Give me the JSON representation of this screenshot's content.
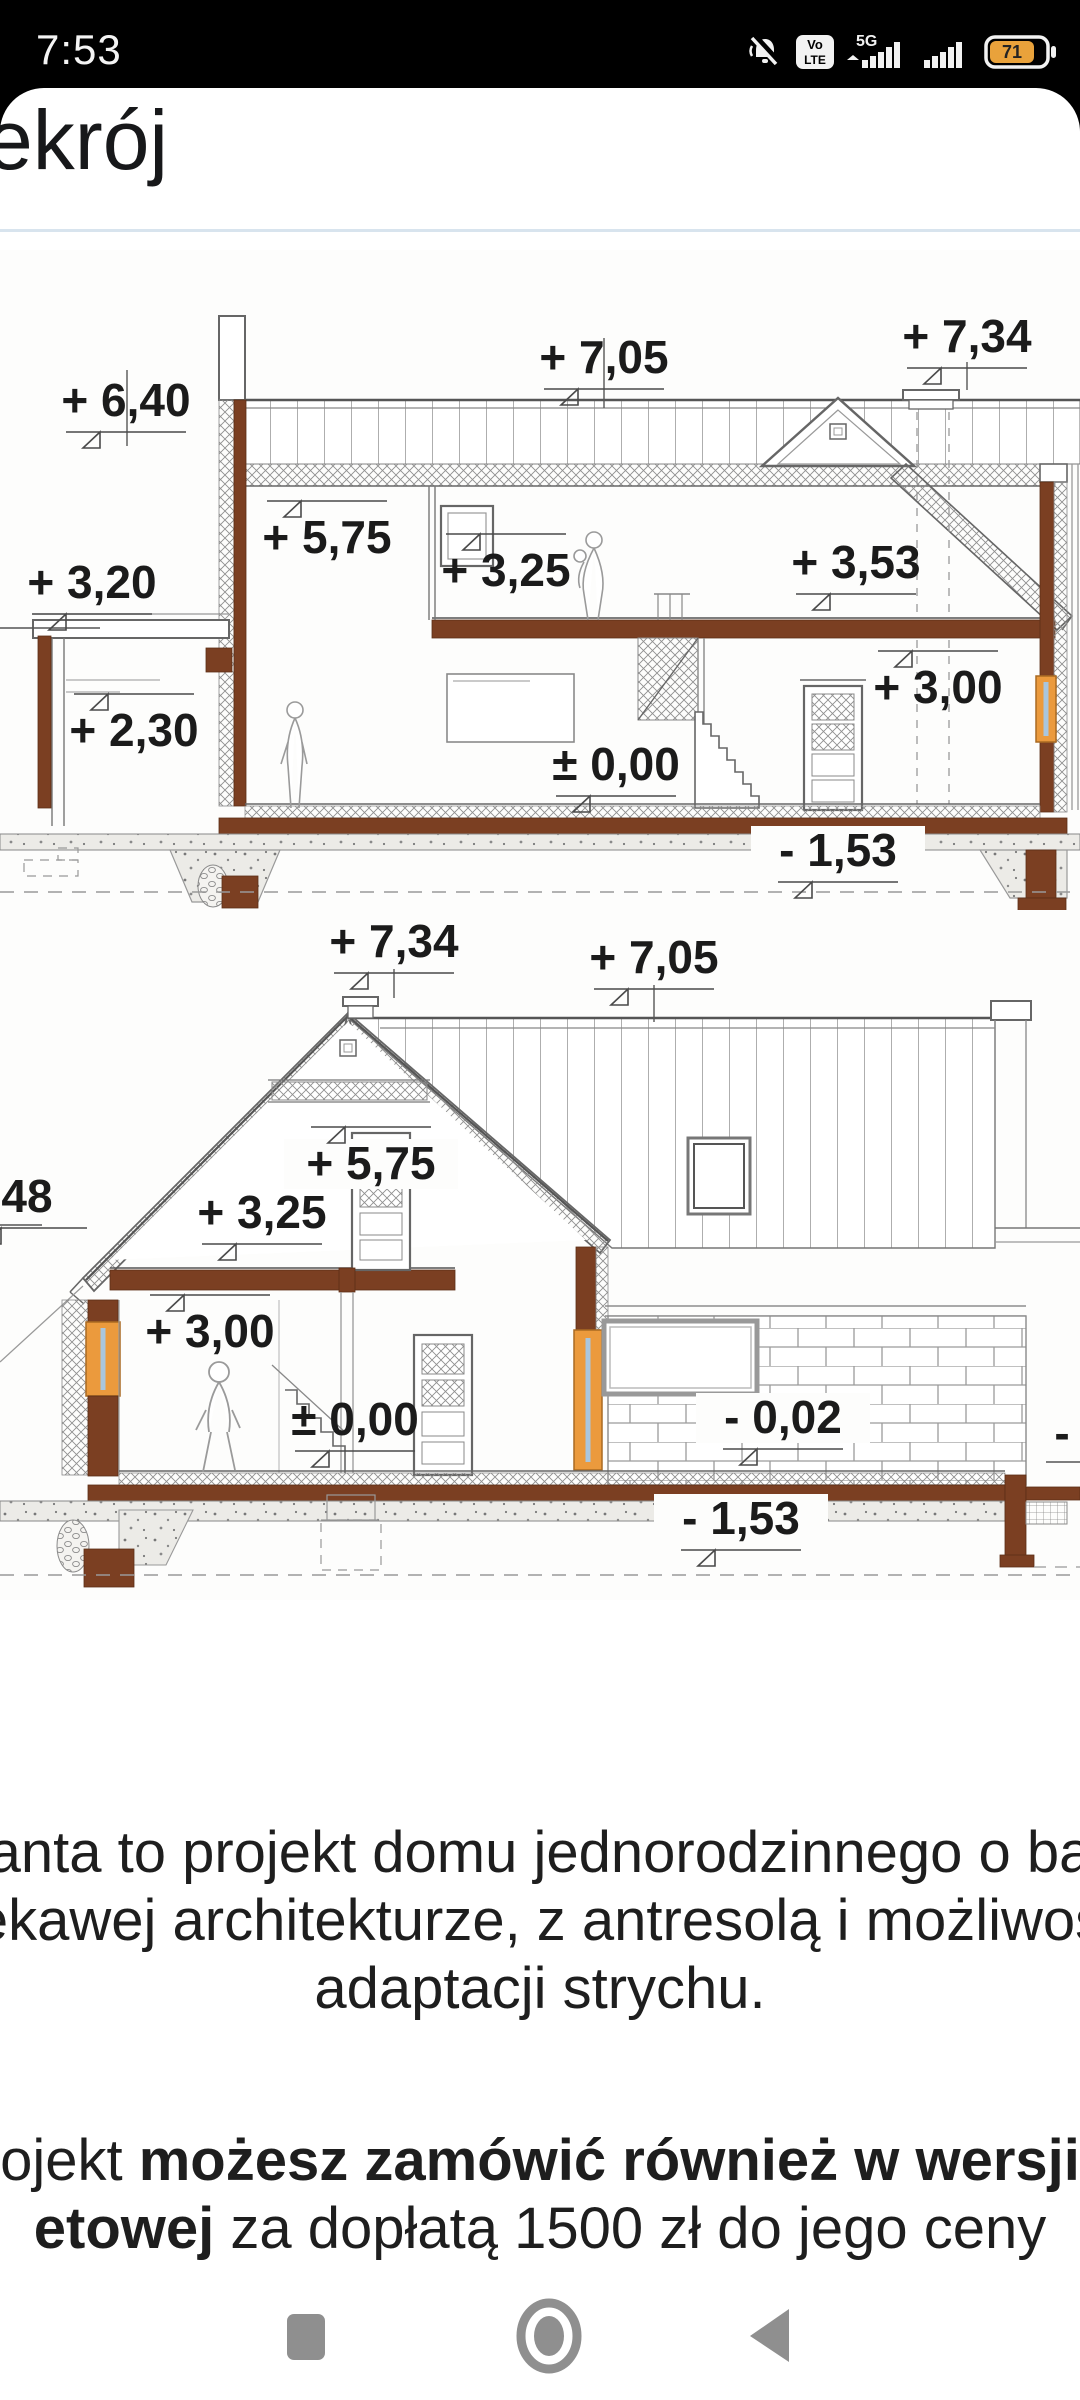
{
  "status_bar": {
    "time": "7:53",
    "volte_top": "Vo",
    "volte_bottom": "LTE",
    "network_label": "5G",
    "battery_percent": "71"
  },
  "header": {
    "title": "ekrój"
  },
  "drawing1": {
    "name": "cross-section longitudinal",
    "labels": [
      {
        "text": "+ 6,40",
        "x": 126,
        "y": 166,
        "f": 1
      },
      {
        "text": "+ 7,05",
        "x": 604,
        "y": 123,
        "f": 1
      },
      {
        "text": "+ 7,34",
        "x": 967,
        "y": 102,
        "f": 1
      },
      {
        "text": "+ 5,75",
        "x": 327,
        "y": 303,
        "f": -1
      },
      {
        "text": "+ 3,25",
        "x": 506,
        "y": 336,
        "f": -1
      },
      {
        "text": "+ 3,53",
        "x": 856,
        "y": 328,
        "f": 1
      },
      {
        "text": "+ 3,20",
        "x": 92,
        "y": 348,
        "f": 1
      },
      {
        "text": "+ 3,00",
        "x": 938,
        "y": 453,
        "f": -1
      },
      {
        "text": "+ 2,30",
        "x": 134,
        "y": 496,
        "f": -1
      },
      {
        "text": "± 0,00",
        "x": 616,
        "y": 530,
        "f": 1
      },
      {
        "text": "- 1,53",
        "x": 838,
        "y": 616,
        "f": 1,
        "bg": 1
      }
    ]
  },
  "drawing2": {
    "name": "cross-section transverse",
    "labels": [
      {
        "text": "+ 7,34",
        "x": 394,
        "y": 47,
        "f": 1
      },
      {
        "text": "+ 7,05",
        "x": 654,
        "y": 63,
        "f": 1
      },
      {
        "text": "48",
        "x": 27,
        "y": 302,
        "f": 1
      },
      {
        "text": "+ 5,75",
        "x": 371,
        "y": 269,
        "f": -1,
        "bg": 1
      },
      {
        "text": "+ 3,25",
        "x": 262,
        "y": 318,
        "f": 1
      },
      {
        "text": "+ 3,00",
        "x": 210,
        "y": 437,
        "f": -1
      },
      {
        "text": "± 0,00",
        "x": 355,
        "y": 525,
        "f": 1
      },
      {
        "text": "- 0,02",
        "x": 783,
        "y": 523,
        "f": 1,
        "bg": 1
      },
      {
        "text": "- 1,53",
        "x": 741,
        "y": 624,
        "f": 1,
        "bg": 1
      },
      {
        "text": "-",
        "x": 1062,
        "y": 539,
        "f": 0
      }
    ]
  },
  "description": {
    "lines": [
      "anta to projekt domu jednorodzinnego o ba",
      "ekawej architekturze, z antresolą i możliwoś",
      "adaptacji strychu."
    ]
  },
  "offer": {
    "line1": [
      {
        "text": "ojekt ",
        "bold": false
      },
      {
        "text": "możesz zamówić również w wersji",
        "bold": true
      }
    ],
    "line2": [
      {
        "text": "etowej",
        "bold": true
      },
      {
        "text": " za dopłatą 1500 zł do jego ceny",
        "bold": false
      }
    ]
  },
  "nav": {
    "icons": [
      "recents",
      "home",
      "back"
    ]
  }
}
